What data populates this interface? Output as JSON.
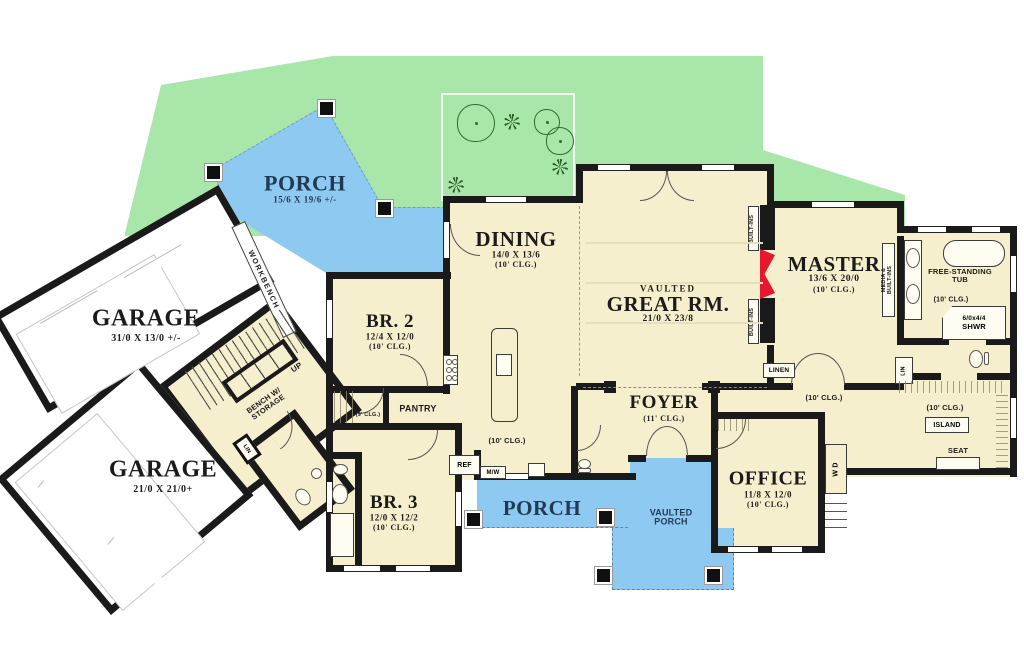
{
  "colors": {
    "yard": "#a9e6a9",
    "porch": "#8ec9f1",
    "floor": "#f6efcd",
    "wall": "#1a1a1a",
    "fireplace": "#e5182e",
    "garage_floor": "#ffffff"
  },
  "rooms": {
    "garage_upper": {
      "name": "GARAGE",
      "dims": "31/0 X 13/0 +/-"
    },
    "garage_lower": {
      "name": "GARAGE",
      "dims": "21/0 X 21/0+"
    },
    "porch_upper": {
      "name": "PORCH",
      "dims": "15/6 X 19/6 +/-"
    },
    "porch_lower": {
      "name": "PORCH"
    },
    "vaulted_porch": {
      "line1": "VAULTED",
      "line2": "PORCH"
    },
    "dining": {
      "name": "DINING",
      "dims": "14/0 X 13/6",
      "clg": "(10' CLG.)"
    },
    "great_room": {
      "vaulted": "VAULTED",
      "name": "GREAT RM.",
      "dims": "21/0 X 23/8"
    },
    "master": {
      "name": "MASTER",
      "dims": "13/6 X 20/0",
      "clg": "(10' CLG.)"
    },
    "br2": {
      "name": "BR. 2",
      "dims": "12/4 X 12/0",
      "clg": "(10' CLG.)"
    },
    "br3": {
      "name": "BR. 3",
      "dims": "12/0 X 12/2",
      "clg": "(10' CLG.)"
    },
    "foyer": {
      "name": "FOYER",
      "clg": "(11' CLG.)"
    },
    "office": {
      "name": "OFFICE",
      "dims": "11/8 X 12/0",
      "clg": "(10' CLG.)"
    }
  },
  "labels": {
    "workbench": "WORKBENCH",
    "bench_line1": "BENCH W/",
    "bench_line2": "STORAGE",
    "up": "UP",
    "pantry": "PANTRY",
    "hall_9_clg": "(9' CLG.)",
    "kitchen_clg": "(10' CLG.)",
    "ref": "REF",
    "mw": "M/W",
    "linen": "LINEN",
    "lin_hall": "LIN",
    "lin_mud": "LIN",
    "wd": "W D",
    "builtins_upper": "BUILT-INS",
    "builtins_lower": "BUILT-INS",
    "media_line1": "MEDIA &",
    "media_line2": "BUILT-INS",
    "tub_line1": "FREE-STANDING",
    "tub_line2": "TUB",
    "bath_clg": "(10' CLG.)",
    "shwr_line1": "6/0x4/4",
    "shwr_line2": "SHWR",
    "closet_clg": "(10' CLG.)",
    "island": "ISLAND",
    "seat": "SEAT",
    "hall_10_clg": "(10' CLG.)"
  }
}
